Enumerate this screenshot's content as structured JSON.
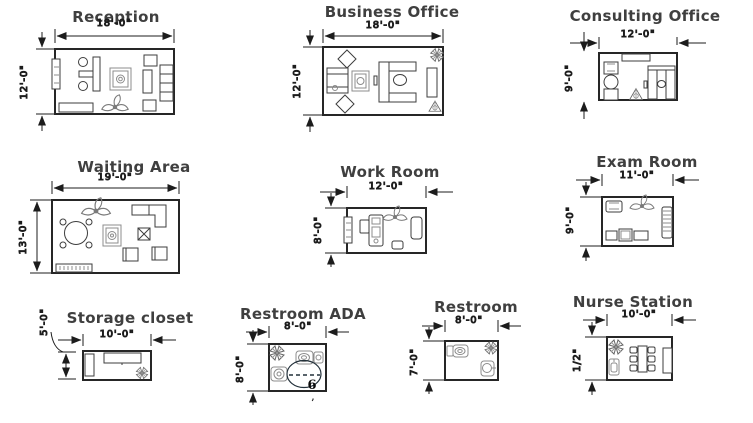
{
  "diagram": {
    "background": "#ffffff",
    "wall_color": "#262626",
    "title_color": "#3f3f3f",
    "dimension_color": "#141414"
  },
  "rooms": {
    "reception": {
      "title": "Reception",
      "width": "18'-0\"",
      "height": "12'-0\""
    },
    "business_office": {
      "title": "Business Office",
      "width": "18'-0\"",
      "height": "12'-0\""
    },
    "consulting_office": {
      "title": "Consulting Office",
      "width": "12'-0\"",
      "height": "9'-0\""
    },
    "waiting_area": {
      "title": "Waiting Area",
      "width": "19'-0\"",
      "height": "13'-0\""
    },
    "work_room": {
      "title": "Work Room",
      "width": "12'-0\"",
      "height": "8'-0\""
    },
    "exam_room": {
      "title": "Exam Room",
      "width": "11'-0\"",
      "height": "9'-0\""
    },
    "storage_closet": {
      "title": "Storage closet",
      "width": "10'-0\"",
      "height": "5'-0\""
    },
    "restroom_ada": {
      "title": "Restroom ADA",
      "width": "8'-0\"",
      "height": "8'-0\"",
      "turning_note": "6",
      "mark": ","
    },
    "restroom": {
      "title": "Restroom",
      "width": "8'-0\"",
      "height": "7'-0\""
    },
    "nurse_station": {
      "title": "Nurse Station",
      "width": "10'-0\"",
      "height": "1/2\""
    }
  }
}
